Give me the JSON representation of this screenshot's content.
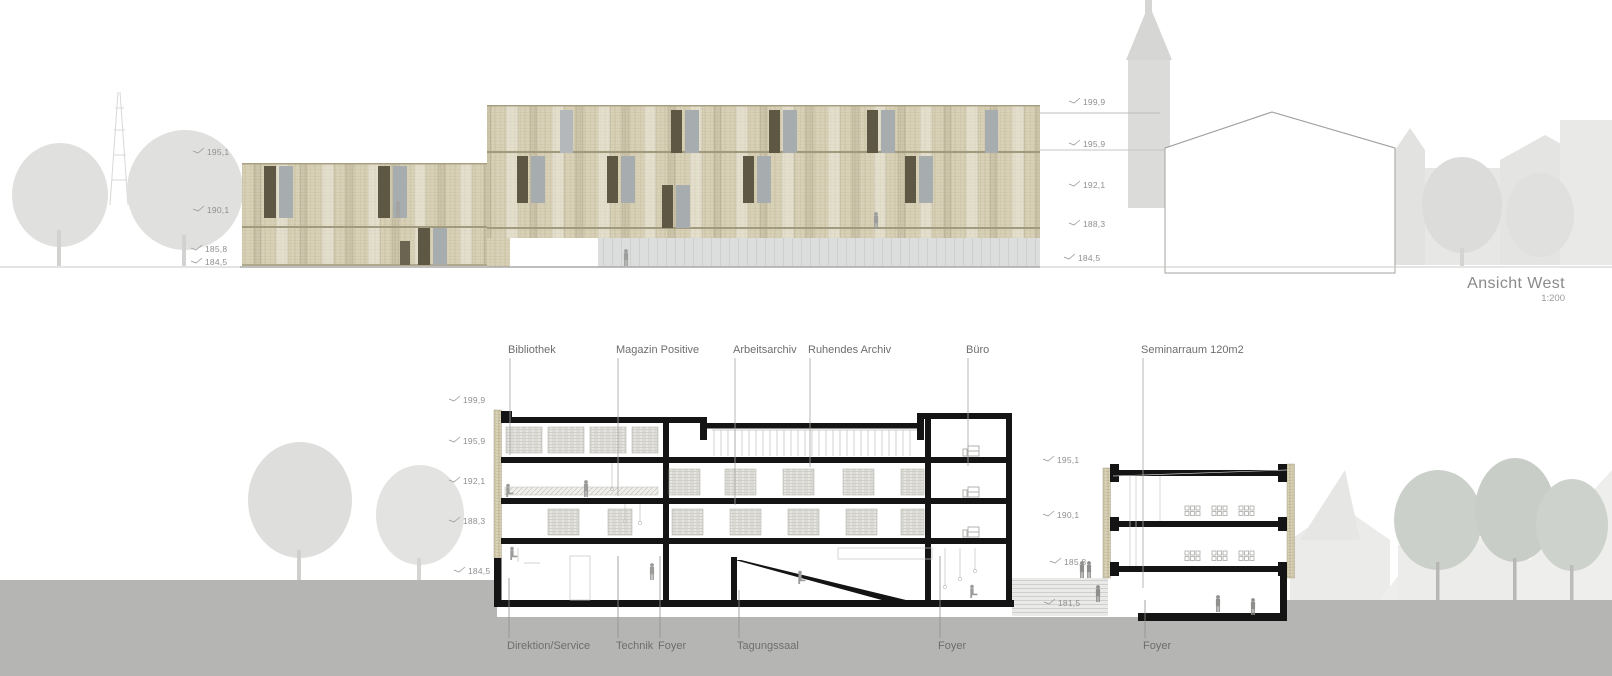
{
  "title": {
    "name": "Ansicht West",
    "scale": "1:200"
  },
  "elevation": {
    "marks_left": [
      "195,1",
      "190,1",
      "185,8",
      "184,5"
    ],
    "marks_right": [
      "199,9",
      "195,9",
      "192,1",
      "188,3",
      "184,5"
    ]
  },
  "section": {
    "marks_left": [
      "199,9",
      "195,9",
      "192,1",
      "188,3",
      "184,5"
    ],
    "marks_right": [
      "195,1",
      "190,1",
      "185,8",
      "181,5"
    ],
    "labels_top": [
      "Bibliothek",
      "Magazin Positive",
      "Arbeitsarchiv",
      "Ruhendes Archiv",
      "Büro",
      "Seminarraum 120m2"
    ],
    "labels_bottom": [
      "Direktion/Service",
      "Technik",
      "Foyer",
      "Tagungssaal",
      "Foyer",
      "Foyer"
    ]
  },
  "colors": {
    "facade_brick": "#d7d0b6",
    "facade_joint": "#bdb494",
    "shutter_dark": "#5e5744",
    "window_gray": "#a7acaf",
    "glazing_gray": "#dcdedd",
    "section_ink": "#141414",
    "ground_gray": "#b5b5b4",
    "faded_context": "#e4e4e2",
    "mark_text": "#8f8f8f",
    "label_text": "#6e6e6e"
  }
}
